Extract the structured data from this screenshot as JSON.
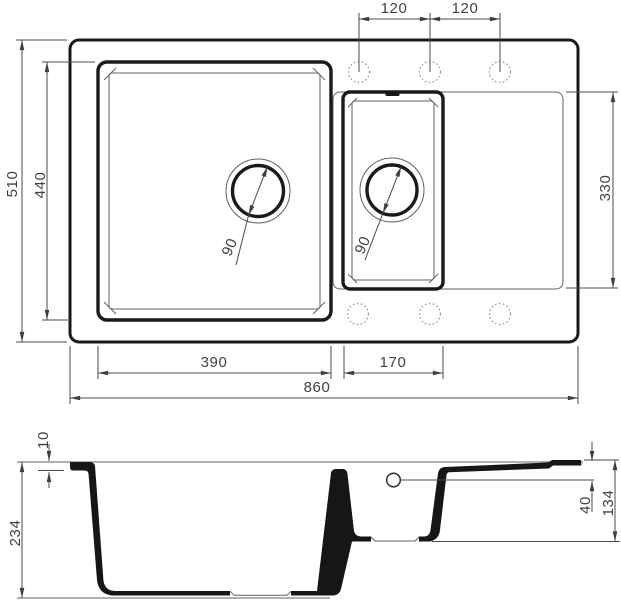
{
  "drawing_type": "sink-dimension-drawing",
  "top_view": {
    "faucet_hole_spacing_left": "120",
    "faucet_hole_spacing_right": "120",
    "overall_depth": "510",
    "main_bowl_depth": "440",
    "right_area_depth": "330",
    "main_bowl_width": "390",
    "half_bowl_width": "170",
    "overall_width": "860",
    "main_drain_diameter": "90",
    "half_drain_diameter": "90"
  },
  "section_view": {
    "rim_thickness": "10",
    "total_depth": "234",
    "drainboard_drop": "40",
    "half_bowl_depth": "134"
  },
  "colors": {
    "outline": "#1a1a1a",
    "thin_line": "#616161",
    "dimension_line": "#4a4a4a",
    "dimension_text": "#414141",
    "hole_dashed": "#9b9b9b",
    "background": "#ffffff"
  }
}
